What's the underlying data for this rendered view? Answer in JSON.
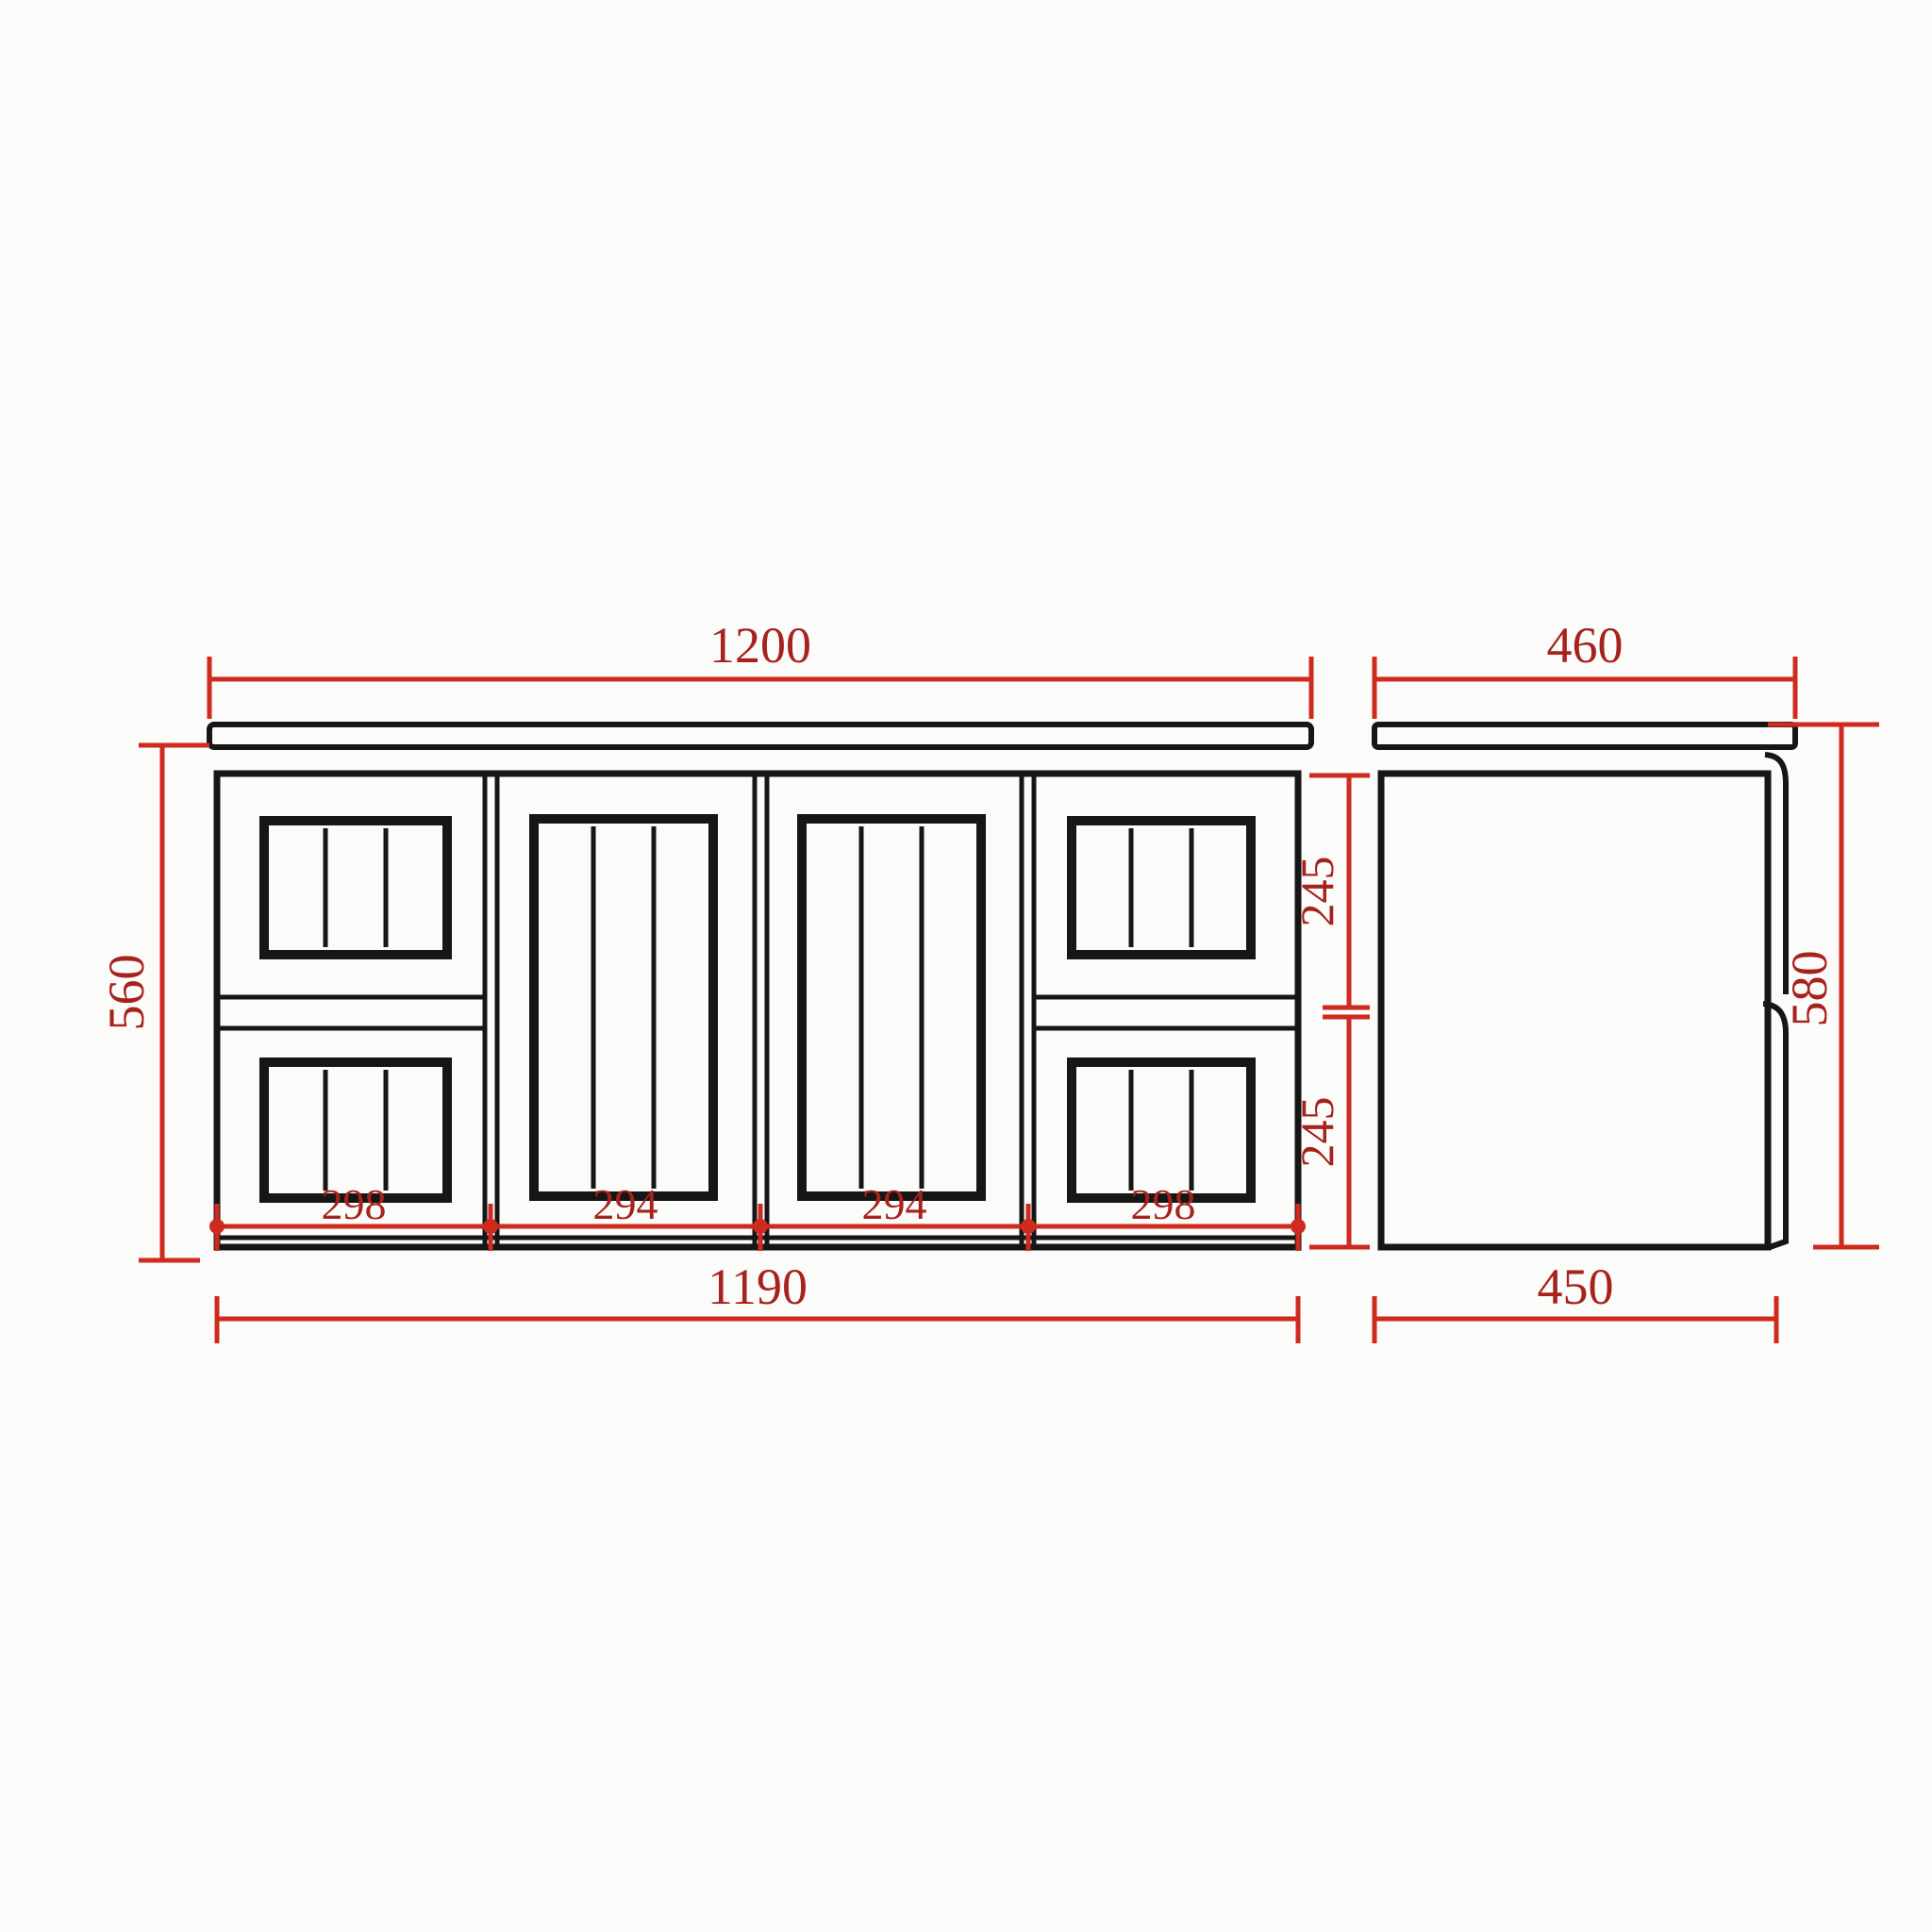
{
  "colors": {
    "line": "#161616",
    "dimension": "#ce2a1e",
    "label": "#a6221c",
    "background": "#fbfbf9"
  },
  "front_view": {
    "top_width": "1200",
    "left_height": "560",
    "bottom_width": "1190",
    "right_upper_height": "245",
    "right_lower_height": "245",
    "segment_widths": [
      "298",
      "294",
      "294",
      "298"
    ]
  },
  "side_view": {
    "top_depth": "460",
    "right_height": "580",
    "bottom_depth": "450"
  }
}
